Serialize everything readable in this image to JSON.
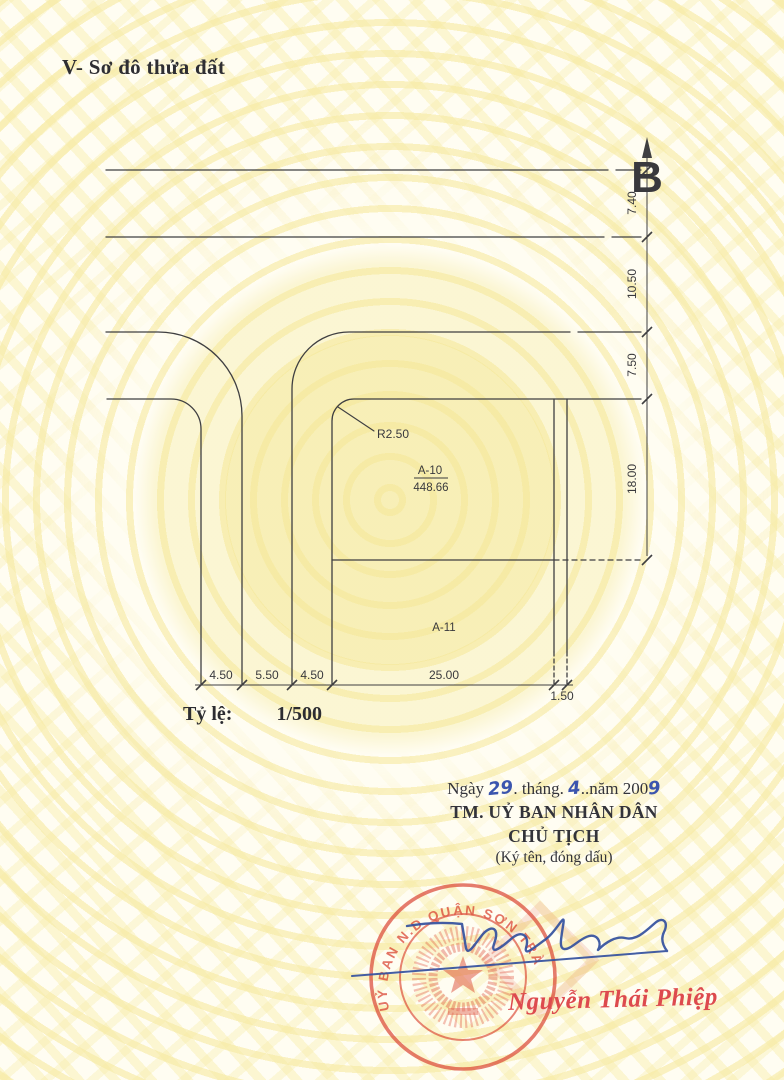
{
  "header": {
    "section_title": "V- Sơ đô thửa đất"
  },
  "diagram": {
    "north_label": "B",
    "radius_label": "R2.50",
    "parcel_a10": {
      "id": "A-10",
      "area": "448.66"
    },
    "parcel_a11": {
      "id": "A-11"
    },
    "dims_right": [
      "7.40",
      "10.50",
      "7.50",
      "18.00"
    ],
    "dims_bottom": [
      "4.50",
      "5.50",
      "4.50",
      "25.00",
      "1.50"
    ]
  },
  "scale": {
    "label": "Tỷ lệ:",
    "value": "1/500"
  },
  "signing": {
    "date": {
      "prefix": "Ngày",
      "day": "29",
      "sep1": ". tháng.",
      "month": "4",
      "sep2": "..năm 200",
      "year_digit": "9"
    },
    "committee": "TM. UỶ BAN NHÂN DÂN",
    "chairman_title": "CHỦ TỊCH",
    "sign_note": "(Ký tên, đóng dấu)",
    "stamp_ring_text": "UỶ BAN N.D QUẬN SƠN TRÀ",
    "signer_name": "Nguyễn Thái Phiệp"
  },
  "colors": {
    "stamp_red": "#d9402e",
    "ink_blue": "#34519f",
    "line_gray": "#3f3f41",
    "pattern_yellow": "#f6e9a2"
  }
}
